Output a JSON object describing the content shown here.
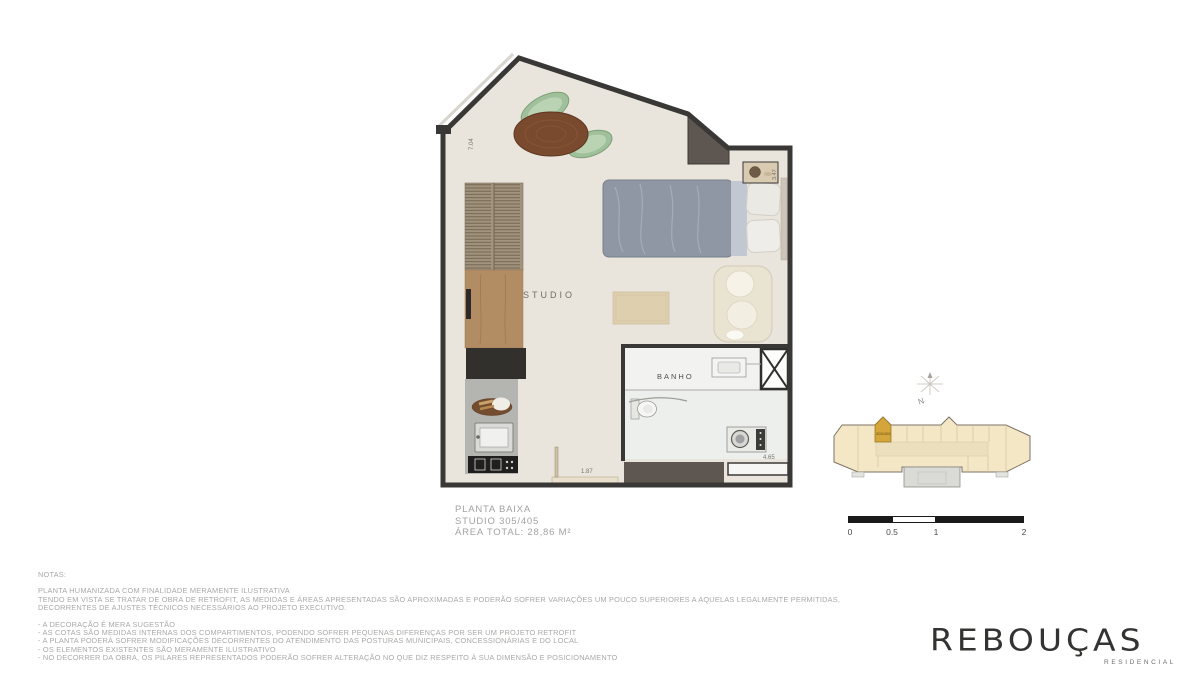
{
  "plan": {
    "room_labels": {
      "studio": "STUDIO",
      "banho": "BANHO"
    },
    "dimensions": {
      "left_wall": "7.04",
      "shelf": "3.47",
      "entry": "1.87",
      "bath": "4.65"
    }
  },
  "title_block": {
    "line1": "PLANTA BAIXA",
    "line2": "STUDIO 305/405",
    "line3": "ÁREA TOTAL: 28,86 M²"
  },
  "key_plan": {
    "north_label": "N",
    "unit_label": "305/405"
  },
  "scale_bar": {
    "labels": [
      "0",
      "0.5",
      "1",
      "2"
    ]
  },
  "notes": {
    "heading": "NOTAS:",
    "paragraph": [
      "PLANTA HUMANIZADA COM FINALIDADE MERAMENTE ILUSTRATIVA",
      "TENDO EM VISTA SE TRATAR DE OBRA DE RETROFIT, AS MEDIDAS E ÁREAS APRESENTADAS SÃO APROXIMADAS E PODERÃO SOFRER VARIAÇÕES UM POUCO SUPERIORES A AQUELAS LEGALMENTE PERMITIDAS,",
      "DECORRENTES DE AJUSTES TÉCNICOS NECESSÁRIOS AO PROJETO EXECUTIVO."
    ],
    "bullets": [
      "- A DECORAÇÃO É MERA SUGESTÃO",
      "- AS COTAS SÃO MEDIDAS INTERNAS DOS COMPARTIMENTOS, PODENDO SOFRER PEQUENAS DIFERENÇAS POR SER UM PROJETO RETROFIT",
      "- A PLANTA PODERÁ SOFRER MODIFICAÇÕES DECORRENTES DO ATENDIMENTO DAS POSTURAS MUNICIPAIS, CONCESSIONÁRIAS E DO LOCAL",
      "- OS ELEMENTOS EXISTENTES SÃO MERAMENTE ILUSTRATIVO",
      "- NO DECORRER DA OBRA, OS PILARES REPRESENTADOS PODERÃO SOFRER ALTERAÇÃO NO QUE DIZ RESPEITO À SUA DIMENSÃO E POSICIONAMENTO"
    ]
  },
  "logo": {
    "name": "REBOUÇAS",
    "tagline": "RESIDENCIAL"
  },
  "colors": {
    "wall": "#3a3836",
    "floor": "#eae5dc",
    "column": "#5e5751",
    "bathroom_floor": "#edefec",
    "highlight_unit": "#d3a53b",
    "keyplan_fill": "#f4e7c5",
    "text_gray": "#a2a2a0",
    "scale_black": "#1a1a1a"
  }
}
